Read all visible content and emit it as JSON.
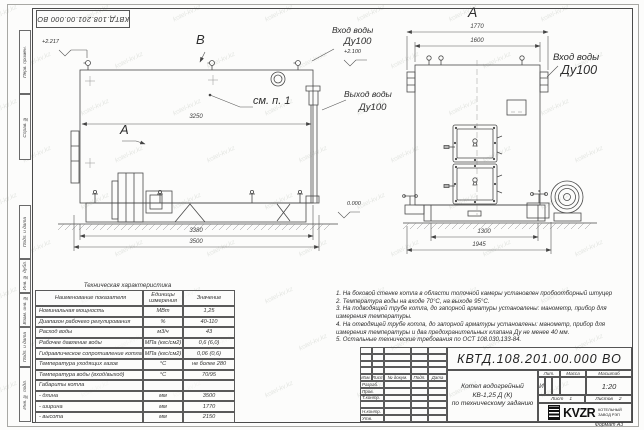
{
  "watermark": {
    "text": "kotel-kv.kz"
  },
  "sheet": {
    "doc_number_top": "КВТД.108.201.00.000  ВО",
    "format_label": "Формат  А3",
    "left_strip": [
      "Перв. примен.",
      "Справ. №",
      "Подп. и дата",
      "Инв. № дубл.",
      "Взам. инв. №",
      "Подп. и дата",
      "Инв. № подл."
    ]
  },
  "views": {
    "side": {
      "view_label_b": "В",
      "view_label_a": "А",
      "callout_see_note": "см. п. 1",
      "dim_3250": "3250",
      "dim_3380": "3380",
      "dim_3500": "3500",
      "elev_top_left": "+2.217",
      "elev_inlet": "+2.100",
      "elev_zero": "0.000",
      "inlet_label_1": "Вход воды",
      "inlet_label_2": "Ду100",
      "outlet_label_1": "Выход воды",
      "outlet_label_2": "Ду100"
    },
    "front": {
      "title": "А",
      "dim_1770": "1770",
      "dim_1600": "1600",
      "dim_1300": "1300",
      "dim_1945": "1945",
      "inlet_label_1": "Вход воды",
      "inlet_label_2": "Ду100"
    }
  },
  "table": {
    "title": "Техническая характеристика",
    "headers": [
      "Наименование показателя",
      "Единицы измерения",
      "Значение"
    ],
    "rows": [
      [
        "Номинальная мощность",
        "МВт",
        "1,25"
      ],
      [
        "Диапазон рабочего регулирования",
        "%",
        "40-110"
      ],
      [
        "Расход воды",
        "м3/ч",
        "43"
      ],
      [
        "Рабочее давление воды",
        "МПа (кгс/см2)",
        "0,6 (6,0)"
      ],
      [
        "Гидравлическое сопротивление котла",
        "МПа (кгс/см2)",
        "0,06 (0,6)"
      ],
      [
        "Температура уходящих газов",
        "°С",
        "не более 280"
      ],
      [
        "Температура воды (вход/выход)",
        "°С",
        "70/95"
      ],
      [
        "Габариты котла",
        "",
        ""
      ],
      [
        "- длина",
        "мм",
        "3500"
      ],
      [
        "- ширина",
        "мм",
        "1770"
      ],
      [
        "- высота",
        "мм",
        "2150"
      ]
    ]
  },
  "notes": [
    "1. На боковой стенке котла в области топочной камеры установлен пробоотборный штуцер",
    "2. Температура воды на входе 70°С, на выходе 95°С.",
    "3. На подводящей трубе котла, до запорной арматуры установлены: манометр, прибор для измерения температуры.",
    "4. На отводящей трубе котла, до запорной арматуры установлены: манометр, прибор для измерения температуры и два предохранительных клапана Ду не менее 40 мм.",
    "5. Остальные технические требования по ОСТ 108.030.133-84."
  ],
  "title_block": {
    "doc_number": "КВТД.108.201.00.000  ВО",
    "product_title": [
      "Котел водогрейный",
      "КВ-1,25 Д (К)",
      "по техническому заданию"
    ],
    "header_cols": [
      "Изм.",
      "Лист",
      "№ докум.",
      "Подп.",
      "Дата"
    ],
    "sign_rows": [
      "Разраб.",
      "Пров.",
      "Т.контр.",
      "",
      "Н.контр.",
      "Утв."
    ],
    "lit_header": [
      "Лит.",
      "Масса",
      "Масштаб"
    ],
    "lit_value": "И",
    "scale_value": "1:20",
    "sheet_label": "Лист",
    "sheet_value": "1",
    "sheets_label": "Листов",
    "sheets_value": "2",
    "logo": {
      "mark": "KVZR",
      "sub1": "КОТЕЛЬНЫЙ",
      "sub2": "ЗАВОД РЭП"
    }
  }
}
